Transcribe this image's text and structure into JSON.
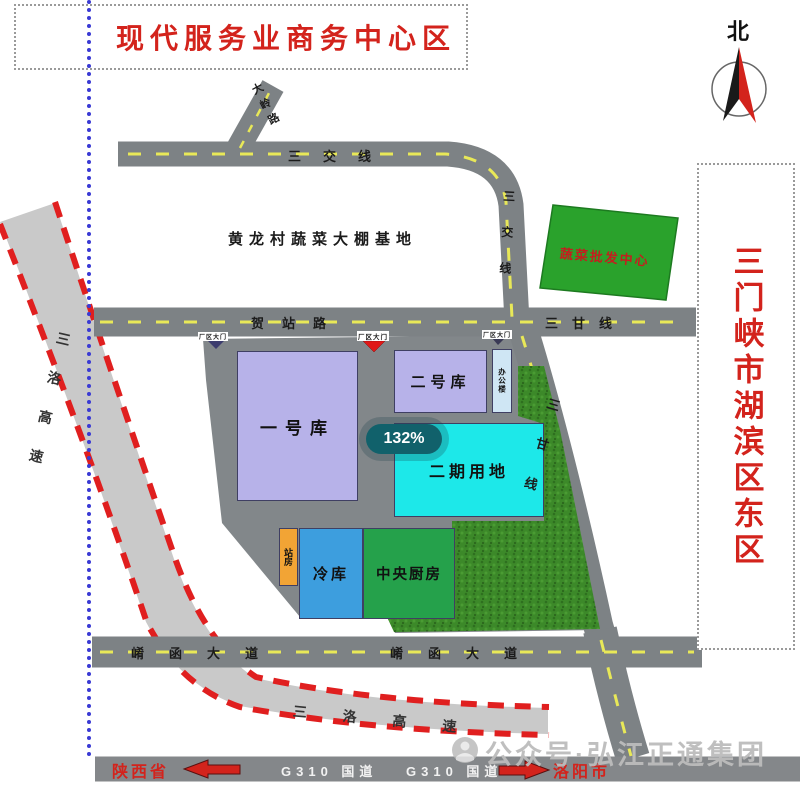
{
  "title": "现代服务业商务中心区",
  "compass": {
    "north_label": "北"
  },
  "region_label": "三门峡市湖滨区东区",
  "zoom_indicator": "132%",
  "watermark": "公众号·弘江正通集团",
  "roads": {
    "sanjiao_line": "三交线",
    "branch_road": "大岭路",
    "hezhan_road": "贺站路",
    "sangan_line": "三甘线",
    "xiaohan_avenue": "崤函大道",
    "g310": "G310 国道",
    "sanluo_expressway": "三洛高速"
  },
  "places": {
    "greenhouse_base": "黄龙村蔬菜大棚基地",
    "wholesale_center": "蔬菜批发中心",
    "warehouse_1": "一号库",
    "warehouse_2": "二号库",
    "office": "办公楼",
    "phase_2": "二期用地",
    "station_house": "站房",
    "cold_storage": "冷库",
    "central_kitchen": "中央厨房",
    "gate": "厂区大门"
  },
  "directions": {
    "west": "陕西省",
    "east": "洛阳市"
  },
  "colors": {
    "title_red": "#d3231c",
    "road_gray": "#7d8285",
    "expressway_gray": "#c9c9c9",
    "dash_yellow": "#e8e858",
    "red_dash": "#e01f1f",
    "warehouse_purple": "#b7b2e9",
    "phase2_cyan": "#1de8e9",
    "office_blue": "#cfe6f4",
    "station_orange": "#f2a435",
    "cold_blue": "#3d9ede",
    "kitchen_green": "#25a14b",
    "wholesale_green": "#2aa22c",
    "grass_green": "#3c8929",
    "badge_teal": "#11616b",
    "boundary_blue": "#3a3ad4",
    "watermark_gray": "#bcbcbc"
  }
}
